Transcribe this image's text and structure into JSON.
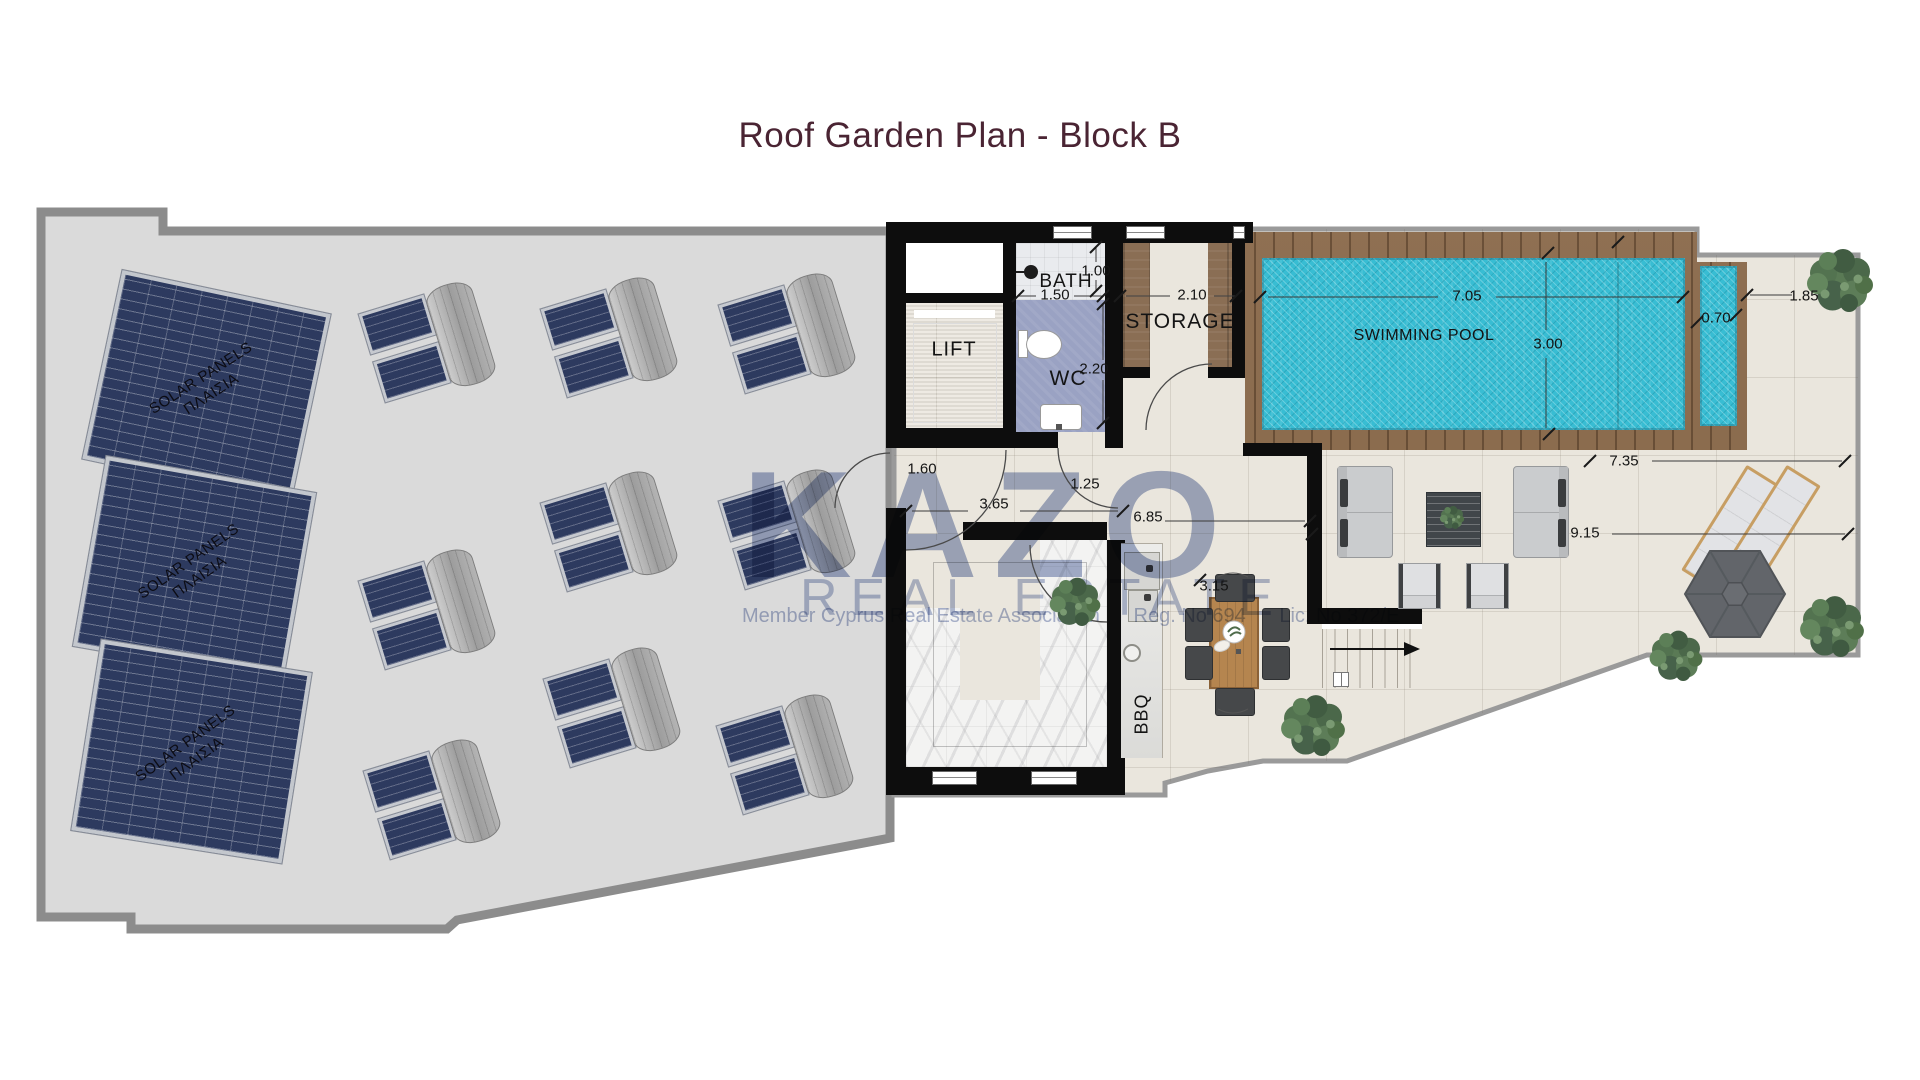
{
  "title": "Roof Garden Plan - Block B",
  "watermark": {
    "logo": "KAZO",
    "subtitle": "REAL ESTATE",
    "association": "Member Cyprus Real Estate Association",
    "reg": "Reg. No 694",
    "lic": "Lic. No 372/E"
  },
  "roof": {
    "solar_label_line1": "SOLAR PANELS",
    "solar_label_line2": "ΠΛΑΙΣΙΑ"
  },
  "rooms": {
    "lift": "LIFT",
    "bath": "BATH",
    "wc": "WC",
    "storage": "STORAGE",
    "pool": "SWIMMING POOL",
    "bbq": "BBQ"
  },
  "dimensions": {
    "bath_width": "1.00",
    "bath_depth": "1.50",
    "wc_depth": "2.20",
    "storage_width": "2.10",
    "pool_length": "7.05",
    "pool_width": "3.00",
    "pool_side": "0.70",
    "deck_right": "1.85",
    "terrace_width": "7.35",
    "terrace_length": "9.15",
    "door_left": "1.60",
    "corridor": "3.65",
    "door_right": "1.25",
    "hall": "6.85",
    "dining": "3.15"
  },
  "colors": {
    "title_text": "#4a2433",
    "watermark_blue": "#5066a0",
    "roof_fill": "#dadada",
    "roof_border": "#8c8c8c",
    "wall_black": "#0d0d0d",
    "terrace_tile": "#eae6dd",
    "pool_water": "#38bdd3",
    "pool_deck_wood": "#8a6848",
    "solar_panel_navy": "#2d3a5f",
    "wc_floor_blue": "#9aa2c3",
    "storage_wood": "#8a6e54",
    "plant_green": "#5a7a55"
  }
}
